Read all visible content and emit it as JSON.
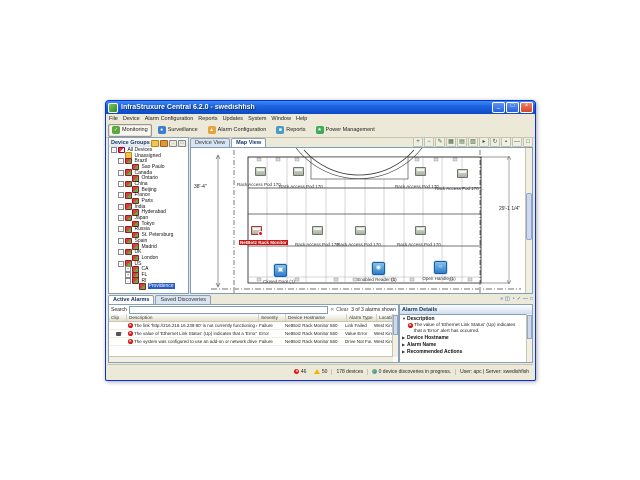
{
  "window": {
    "title": "InfraStruxure Central 6.2.0 - swedishfish",
    "controls": {
      "minimize": "_",
      "maximize": "□",
      "close": "×"
    }
  },
  "menu": {
    "items": [
      "File",
      "Device",
      "Alarm Configuration",
      "Reports",
      "Updates",
      "System",
      "Window",
      "Help"
    ]
  },
  "toolbar": {
    "buttons": [
      {
        "label": "Monitoring",
        "color": "#5aa83e",
        "glyph": "✓",
        "active": true
      },
      {
        "label": "Surveillance",
        "color": "#3b7fd4",
        "glyph": "●",
        "active": false
      },
      {
        "label": "Alarm Configuration",
        "color": "#e8a33d",
        "glyph": "▲",
        "active": false
      },
      {
        "label": "Reports",
        "color": "#4a9ac7",
        "glyph": "■",
        "active": false
      },
      {
        "label": "Power Management",
        "color": "#3faa5c",
        "glyph": "★",
        "active": false
      }
    ]
  },
  "sidebar": {
    "title": "Device Groups",
    "tree": [
      {
        "label": "All Devices",
        "level": 0,
        "icon": "devices",
        "exp": "-"
      },
      {
        "label": "Unassigned",
        "level": 1,
        "icon": "folder"
      },
      {
        "label": "Brazil",
        "level": 1,
        "icon": "group",
        "exp": "-"
      },
      {
        "label": "Sao Paulo",
        "level": 2,
        "icon": "group"
      },
      {
        "label": "Canada",
        "level": 1,
        "icon": "group",
        "exp": "-"
      },
      {
        "label": "Ontario",
        "level": 2,
        "icon": "group"
      },
      {
        "label": "China",
        "level": 1,
        "icon": "group",
        "exp": "-"
      },
      {
        "label": "Beijing",
        "level": 2,
        "icon": "group"
      },
      {
        "label": "France",
        "level": 1,
        "icon": "group",
        "exp": "-"
      },
      {
        "label": "Paris",
        "level": 2,
        "icon": "group"
      },
      {
        "label": "India",
        "level": 1,
        "icon": "group",
        "exp": "-"
      },
      {
        "label": "Hyderabad",
        "level": 2,
        "icon": "group"
      },
      {
        "label": "Japan",
        "level": 1,
        "icon": "group",
        "exp": "-"
      },
      {
        "label": "Tokyo",
        "level": 2,
        "icon": "group"
      },
      {
        "label": "Russia",
        "level": 1,
        "icon": "group",
        "exp": "-"
      },
      {
        "label": "St. Petersburg",
        "level": 2,
        "icon": "group"
      },
      {
        "label": "Spain",
        "level": 1,
        "icon": "group",
        "exp": "-"
      },
      {
        "label": "Madrid",
        "level": 2,
        "icon": "group"
      },
      {
        "label": "UK",
        "level": 1,
        "icon": "group",
        "exp": "-"
      },
      {
        "label": "London",
        "level": 2,
        "icon": "group"
      },
      {
        "label": "US",
        "level": 1,
        "icon": "group",
        "exp": "-"
      },
      {
        "label": "CA",
        "level": 2,
        "icon": "group",
        "exp": "+"
      },
      {
        "label": "FL",
        "level": 2,
        "icon": "group",
        "exp": "+"
      },
      {
        "label": "RI",
        "level": 2,
        "icon": "group",
        "exp": "-"
      },
      {
        "label": "Providence",
        "level": 3,
        "icon": "group",
        "selected": true
      }
    ]
  },
  "main": {
    "tabs": [
      {
        "label": "Device View",
        "active": false
      },
      {
        "label": "Map View",
        "active": true
      }
    ],
    "map_toolbar": [
      {
        "name": "zoom-in-icon",
        "glyph": "+"
      },
      {
        "name": "zoom-out-icon",
        "glyph": "−"
      },
      {
        "name": "edit-map-icon",
        "glyph": "✎"
      },
      {
        "name": "grid-layout-icon",
        "glyph": "▦"
      },
      {
        "name": "table-layout-icon",
        "glyph": "▤"
      },
      {
        "name": "layers-icon",
        "glyph": "▧"
      },
      {
        "name": "select-icon",
        "glyph": "▸"
      },
      {
        "name": "refresh-map-icon",
        "glyph": "↻"
      },
      {
        "name": "lock-map-icon",
        "glyph": "▪"
      },
      {
        "name": "minimize-panel-icon",
        "glyph": "—"
      },
      {
        "name": "maximize-panel-icon",
        "glyph": "□"
      }
    ],
    "map": {
      "dim_labels": [
        {
          "t": "38'-4\"",
          "x": 3,
          "y": 36
        },
        {
          "t": "29'-1 1/4\"",
          "x": 308,
          "y": 58
        }
      ],
      "rack_labels": [
        {
          "t": "Rack Access Pod 170 ...",
          "x": 46,
          "y": 34
        },
        {
          "t": "Rack Access Pod 170 ...",
          "x": 88,
          "y": 36
        },
        {
          "t": "Rack Access Pod 170 ...",
          "x": 204,
          "y": 36
        },
        {
          "t": "Rack Access Pod 170 ...",
          "x": 244,
          "y": 38
        },
        {
          "t": "Rack Access Pod 170 ...",
          "x": 104,
          "y": 94
        },
        {
          "t": "Rack Access Pod 170 ...",
          "x": 146,
          "y": 94
        },
        {
          "t": "Rack Access Pod 170 ...",
          "x": 206,
          "y": 94
        }
      ],
      "alarm_label": {
        "t": "NetBotz Rack Monitor",
        "x": 48,
        "y": 92
      },
      "status_labels": [
        {
          "t": "Closed Door (1)",
          "x": 88,
          "y": 131,
          "name": "closed-door-label"
        },
        {
          "t": "Enabled Reader (1)",
          "x": 186,
          "y": 129,
          "name": "enabled-reader-label"
        },
        {
          "t": "Open Handle (1)",
          "x": 248,
          "y": 128,
          "name": "open-handle-label"
        }
      ],
      "rack_icons": [
        {
          "x": 64,
          "y": 19
        },
        {
          "x": 102,
          "y": 19
        },
        {
          "x": 224,
          "y": 19
        },
        {
          "x": 266,
          "y": 21
        },
        {
          "x": 121,
          "y": 78
        },
        {
          "x": 164,
          "y": 78
        },
        {
          "x": 224,
          "y": 78
        }
      ],
      "alarm_icon": {
        "x": 60,
        "y": 78
      },
      "access_icons": [
        {
          "x": 83,
          "y": 116,
          "name": "closed-door-icon",
          "glyph": "▣"
        },
        {
          "x": 181,
          "y": 114,
          "name": "enabled-reader-icon",
          "glyph": "◉"
        },
        {
          "x": 243,
          "y": 113,
          "name": "open-handle-icon",
          "glyph": "○"
        }
      ]
    }
  },
  "alarms": {
    "tabs": [
      {
        "label": "Active Alarms",
        "active": true
      },
      {
        "label": "Saved Discoveries",
        "active": false
      }
    ],
    "search_label": "Search",
    "clear_label": "Clear",
    "count_label": "3 of 3 alarms shown",
    "columns": [
      {
        "label": "Clip",
        "w": 14
      },
      {
        "label": "Description",
        "w": 128
      },
      {
        "label": "Severity",
        "w": 23
      },
      {
        "label": "Device Hostname",
        "w": 57
      },
      {
        "label": "Alarm Type",
        "w": 26
      },
      {
        "label": "Location",
        "w": 36
      }
    ],
    "rows": [
      {
        "clip": false,
        "description": "The link 'http://216.216.16.239:80' is not currently functioning corre...",
        "severity": "Failure",
        "hostname": "NetBotz Rack Monitor 550",
        "type": "Link Failed",
        "location": "West Kingston"
      },
      {
        "clip": true,
        "description": "The value of 'Ethernet Link Status' (Up) indicates that a 'Error' alert ...",
        "severity": "Error",
        "hostname": "NetBotz Rack Monitor 550",
        "type": "Value Error",
        "location": "West Kingston"
      },
      {
        "clip": false,
        "description": "The system was configured to use an add-on or network drive for s...",
        "severity": "Failure",
        "hostname": "NetBotz Rack Monitor 550",
        "type": "Drive Not Found",
        "location": "West Kingston"
      }
    ]
  },
  "details": {
    "title": "Alarm Details",
    "icons": [
      {
        "name": "double-arrow-icon",
        "glyph": "»"
      },
      {
        "name": "window-icon",
        "glyph": "◫"
      },
      {
        "name": "clock-icon",
        "glyph": "◔"
      },
      {
        "name": "check-icon",
        "glyph": "✓"
      },
      {
        "name": "minimize-details-icon",
        "glyph": "—"
      },
      {
        "name": "maximize-details-icon",
        "glyph": "□"
      }
    ],
    "sections": [
      {
        "label": "Description",
        "expanded": true,
        "body": "The value of 'Ethernet Link Status' (Up) indicates that a 'Error' alert has occurred."
      },
      {
        "label": "Device Hostname",
        "expanded": false
      },
      {
        "label": "Alarm Name",
        "expanded": false
      },
      {
        "label": "Recommended Actions",
        "expanded": false
      }
    ]
  },
  "statusbar": {
    "error_count": "46",
    "warning_count": "50",
    "devices": "178 devices",
    "discovery": "0 device discoveries in progress.",
    "session": "User: apc | Server: swedishfish"
  }
}
